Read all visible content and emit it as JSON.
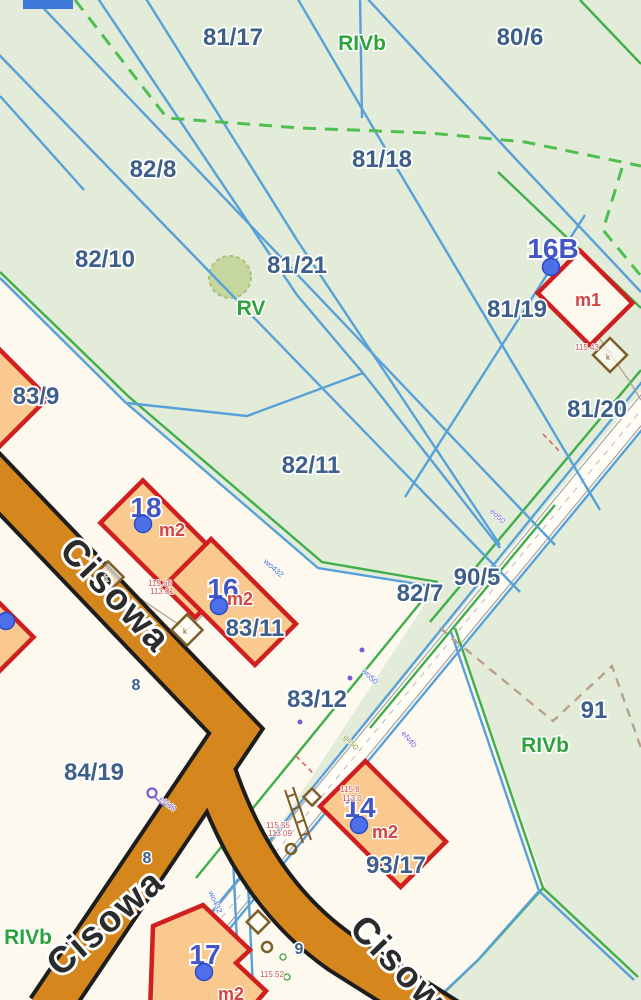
{
  "colors": {
    "bg_green": "#e2ecd8",
    "bg_cream": "#fdf9ee",
    "strip_fill": "#fffdf6",
    "parcel_line_blue": "#58a0d8",
    "boundary_green": "#3fae4b",
    "dashed_green": "#4fbf52",
    "dashed_brown": "#b9a189",
    "dashed_red": "#e06060",
    "road_fill": "#d5861d",
    "road_edge": "#1d1d1d",
    "building_stroke": "#cf1f1f",
    "building_fill": "#f9c98f",
    "shed_stroke": "#7c5e2a",
    "label_parcel": "#3e5f8a",
    "label_building": "#4356c5",
    "label_land_use": "#d04545",
    "label_soil": "#2ea23c",
    "street_text": "#2b2b2b",
    "address_dot": "#4d6fe8",
    "ui_fragment_blue": "#3c78d8"
  },
  "labels": {
    "parcels": [
      {
        "t": "81/17",
        "x": 233,
        "y": 45
      },
      {
        "t": "80/6",
        "x": 520,
        "y": 45
      },
      {
        "t": "82/8",
        "x": 153,
        "y": 177
      },
      {
        "t": "81/18",
        "x": 382,
        "y": 167
      },
      {
        "t": "82/10",
        "x": 105,
        "y": 267
      },
      {
        "t": "81/21",
        "x": 297,
        "y": 273
      },
      {
        "t": "81/19",
        "x": 517,
        "y": 317
      },
      {
        "t": "81/20",
        "x": 597,
        "y": 417
      },
      {
        "t": "83/9",
        "x": 36,
        "y": 404
      },
      {
        "t": "82/11",
        "x": 311,
        "y": 473
      },
      {
        "t": "83/11",
        "x": 255,
        "y": 636
      },
      {
        "t": "82/7",
        "x": 420,
        "y": 601
      },
      {
        "t": "90/5",
        "x": 477,
        "y": 585
      },
      {
        "t": "83/12",
        "x": 317,
        "y": 707
      },
      {
        "t": "91",
        "x": 594,
        "y": 718
      },
      {
        "t": "84/19",
        "x": 94,
        "y": 780
      },
      {
        "t": "93/17",
        "x": 396,
        "y": 873
      }
    ],
    "buildings": [
      {
        "t": "16B",
        "x": 553,
        "y": 258
      },
      {
        "t": "18",
        "x": 146,
        "y": 517
      },
      {
        "t": "16",
        "x": 223,
        "y": 598
      },
      {
        "t": "14",
        "x": 360,
        "y": 817
      },
      {
        "t": "17",
        "x": 205,
        "y": 964
      }
    ],
    "land_use": [
      {
        "t": "m1",
        "x": 588,
        "y": 306
      },
      {
        "t": "m2",
        "x": 172,
        "y": 536
      },
      {
        "t": "m2",
        "x": 240,
        "y": 605
      },
      {
        "t": "m2",
        "x": 385,
        "y": 838
      },
      {
        "t": "m2",
        "x": 231,
        "y": 1000
      }
    ],
    "soil": [
      {
        "t": "RIVb",
        "x": 362,
        "y": 50
      },
      {
        "t": "RV",
        "x": 251,
        "y": 315
      },
      {
        "t": "RIVb",
        "x": 545,
        "y": 752
      },
      {
        "t": "RIVb",
        "x": 28,
        "y": 944
      }
    ],
    "streets": [
      {
        "t": "Cisowa",
        "x": 58,
        "y": 552,
        "r": 46.5
      },
      {
        "t": "Cisowa",
        "x": 60,
        "y": 978,
        "r": -41
      },
      {
        "t": "Cisowa",
        "x": 348,
        "y": 930,
        "r": 46
      }
    ],
    "addresses": [
      {
        "t": "8",
        "x": 136,
        "y": 690
      },
      {
        "t": "8",
        "x": 147,
        "y": 863
      },
      {
        "t": "9",
        "x": 299,
        "y": 954
      }
    ],
    "tiny": [
      {
        "t": "115.60",
        "x": 160,
        "y": 586,
        "c": "red",
        "r": 0
      },
      {
        "t": "113.01",
        "x": 162,
        "y": 594,
        "c": "red",
        "r": 0
      },
      {
        "t": "115.55",
        "x": 278,
        "y": 828,
        "c": "red",
        "r": 0
      },
      {
        "t": "113.09",
        "x": 280,
        "y": 836,
        "c": "red",
        "r": 0
      },
      {
        "t": "115.52",
        "x": 272,
        "y": 977,
        "c": "red",
        "r": 0
      },
      {
        "t": "115.43",
        "x": 587,
        "y": 350,
        "c": "red",
        "r": 0
      },
      {
        "t": "115.8",
        "x": 350,
        "y": 792,
        "c": "red",
        "r": 0
      },
      {
        "t": "113.0",
        "x": 352,
        "y": 801,
        "c": "red",
        "r": 0
      },
      {
        "t": "wo432",
        "x": 272,
        "y": 570,
        "c": "blue",
        "r": 42
      },
      {
        "t": "wo432",
        "x": 213,
        "y": 903,
        "c": "blue",
        "r": 66
      },
      {
        "t": "wo50",
        "x": 368,
        "y": 678,
        "c": "blue",
        "r": 45
      },
      {
        "t": "eo50",
        "x": 496,
        "y": 518,
        "c": "purple",
        "r": 43
      },
      {
        "t": "eNd0",
        "x": 166,
        "y": 806,
        "c": "purple",
        "r": 38
      },
      {
        "t": "eN40",
        "x": 407,
        "y": 741,
        "c": "purple",
        "r": 50
      },
      {
        "t": "gn50",
        "x": 349,
        "y": 744,
        "c": "olive",
        "r": 48
      },
      {
        "t": "k",
        "x": 106,
        "y": 581,
        "c": "brown",
        "r": 0
      },
      {
        "t": "k",
        "x": 185,
        "y": 634,
        "c": "brown",
        "r": 0
      },
      {
        "t": "k",
        "x": 608,
        "y": 360,
        "c": "brown",
        "r": 0
      }
    ]
  },
  "markers": {
    "address_dots": [
      [
        551,
        267
      ],
      [
        143,
        524
      ],
      [
        219,
        606
      ],
      [
        359,
        825
      ],
      [
        204,
        972
      ],
      [
        6,
        621
      ]
    ],
    "wells": [
      [
        267,
        947
      ],
      [
        291,
        849
      ]
    ]
  }
}
